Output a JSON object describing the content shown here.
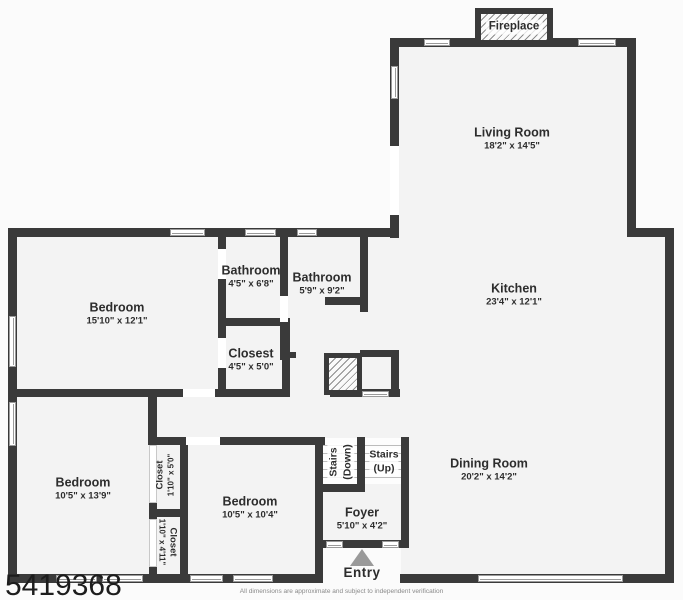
{
  "floorplan": {
    "rooms": {
      "living": {
        "name": "Living Room",
        "dims": "18'2\" x 14'5\""
      },
      "kitchen": {
        "name": "Kitchen",
        "dims": "23'4\" x 12'1\""
      },
      "dining": {
        "name": "Dining Room",
        "dims": "20'2\" x 14'2\""
      },
      "bedroom_main": {
        "name": "Bedroom",
        "dims": "15'10\" x 12'1\""
      },
      "bedroom_left": {
        "name": "Bedroom",
        "dims": "10'5\" x 13'9\""
      },
      "bedroom_mid": {
        "name": "Bedroom",
        "dims": "10'5\" x 10'4\""
      },
      "bathroom_hall": {
        "name": "Bathroom",
        "dims": "4'5\" x 6'8\""
      },
      "bathroom_main": {
        "name": "Bathroom",
        "dims": "5'9\" x 9'2\""
      },
      "closet_hall": {
        "name": "Closest",
        "dims": "4'5\" x 5'0\""
      },
      "closet_upper": {
        "name": "Closet",
        "dims": "1'10\" x 5'0\""
      },
      "closet_lower": {
        "name": "Closet",
        "dims": "1'10\" x 4'11\""
      },
      "stairs_down": {
        "name": "Stairs",
        "dims": "(Down)"
      },
      "stairs_up": {
        "name": "Stairs",
        "dims": "(Up)"
      },
      "foyer": {
        "name": "Foyer",
        "dims": "5'10\" x 4'2\""
      }
    },
    "fireplace_label": "Fireplace",
    "entry_label": "Entry",
    "watermark": "5419368",
    "disclaimer": "All dimensions are approximate and subject to independent verification",
    "colors": {
      "wall": "#3a3a3a",
      "floor": "#f3f3f3",
      "background": "#fbfbfb",
      "entry_arrow": "#9a9a9a"
    }
  }
}
